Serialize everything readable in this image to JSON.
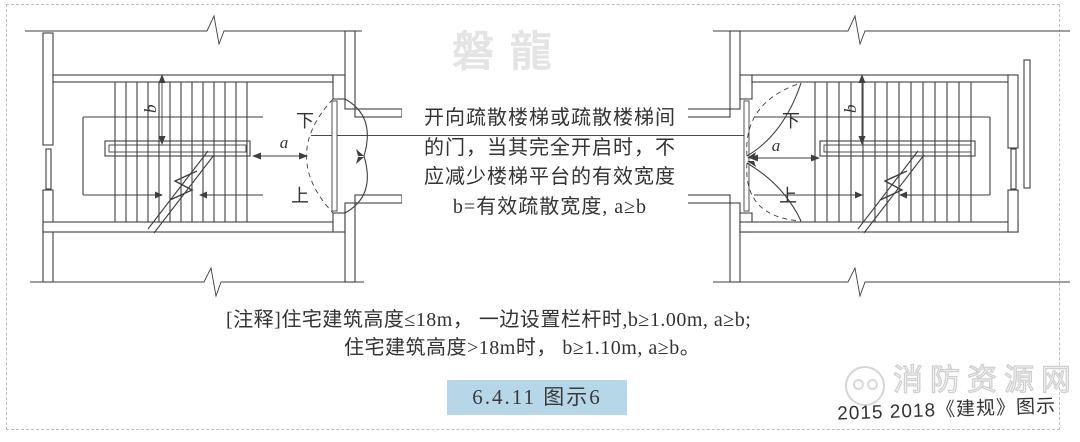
{
  "watermarks": {
    "brand": "磐龍",
    "site": "消防资源网"
  },
  "annotation": {
    "lines": [
      "开向疏散楼梯或疏散楼梯间",
      "的门，当其完全开启时，不",
      "应减少楼梯平台的有效宽度",
      "b=有效疏散宽度, a≥b"
    ]
  },
  "note": {
    "line1": "[注释]住宅建筑高度≤18m， 一边设置栏杆时,b≥1.00m, a≥b;",
    "line2": "住宅建筑高度>18m时， b≥1.10m, a≥b。"
  },
  "badge": {
    "label": "6.4.11 图示6"
  },
  "caption": {
    "text": "2015 2018《建规》图示"
  },
  "diagrams": {
    "left": {
      "labels": {
        "down": "下",
        "up": "上",
        "a": "a",
        "b": "b"
      }
    },
    "right": {
      "labels": {
        "down": "下",
        "up": "上",
        "a": "a",
        "b": "b"
      }
    }
  },
  "colors": {
    "badge_bg": "#b5d7e8",
    "line": "#3f3f3f",
    "watermark": "#e4e4e4"
  }
}
